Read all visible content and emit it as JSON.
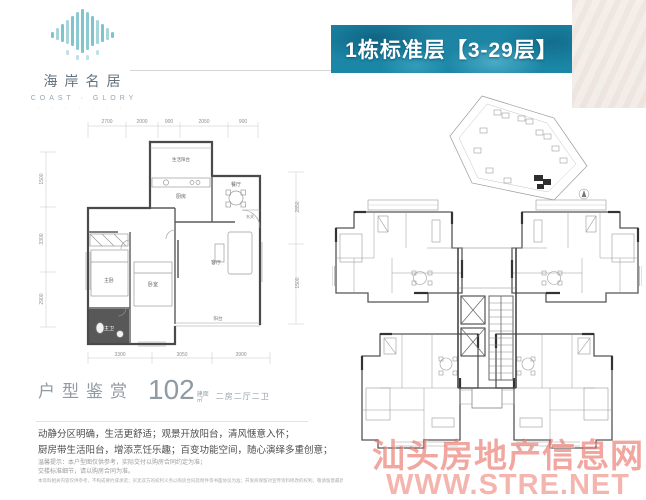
{
  "brand": {
    "name_cn": "海岸名居",
    "name_en": "COAST · GLORY",
    "tagline_dots": "· · · · · · ·"
  },
  "banner": {
    "title": "1栋标准层【3-29层】"
  },
  "colors": {
    "banner_teal": "#1b86a6",
    "logo_teal": "#7fc3cd",
    "accent_gray": "#8f9aa3",
    "watermark_red": "#e44e40"
  },
  "unit_plan": {
    "dims_top": [
      "2700",
      "2000",
      "900",
      "2050",
      "900"
    ],
    "dims_left": [
      "1500",
      "3300",
      "2900"
    ],
    "dims_right": [
      "2850",
      "1500"
    ],
    "dims_bottom": [
      "3300",
      "3050",
      "3900"
    ],
    "rooms": {
      "service_balcony": "生活阳台",
      "kitchen": "厨房",
      "dining": "餐厅",
      "entry": "玄关",
      "living": "客厅",
      "balcony": "阳台",
      "master_bedroom": "主卧",
      "bedroom": "卧室",
      "master_bath": "主卫"
    }
  },
  "unit_info": {
    "section_title": "户型鉴赏",
    "area_value": "102",
    "area_label_top": "建面",
    "area_label_bottom": "㎡",
    "layout_text": "二房二厅二卫"
  },
  "description": {
    "line1": "动静分区明确，生活更舒适；观景开放阳台，清风惬意入怀；",
    "line2": "厨房带生活阳台，增添烹饪乐趣；百变功能空间，随心演绎多重创意；"
  },
  "disclaimer": {
    "line1": "温馨提示：本户型图仅供参考，实际交付以购房合同约定为准；",
    "line2": "交楼标准细节，请以购房合同为准。",
    "line3": "本资料相关内容仅供参考，不构成要约或承诺；买卖双方的权利义务以购房合同及附件等书面协议为准；开发商保留对宣传资料修改的权利，敬请留意最新资料。"
  },
  "watermark": {
    "line1": "汕头房地产信息网",
    "line2": "WWW.STRE.NET"
  }
}
